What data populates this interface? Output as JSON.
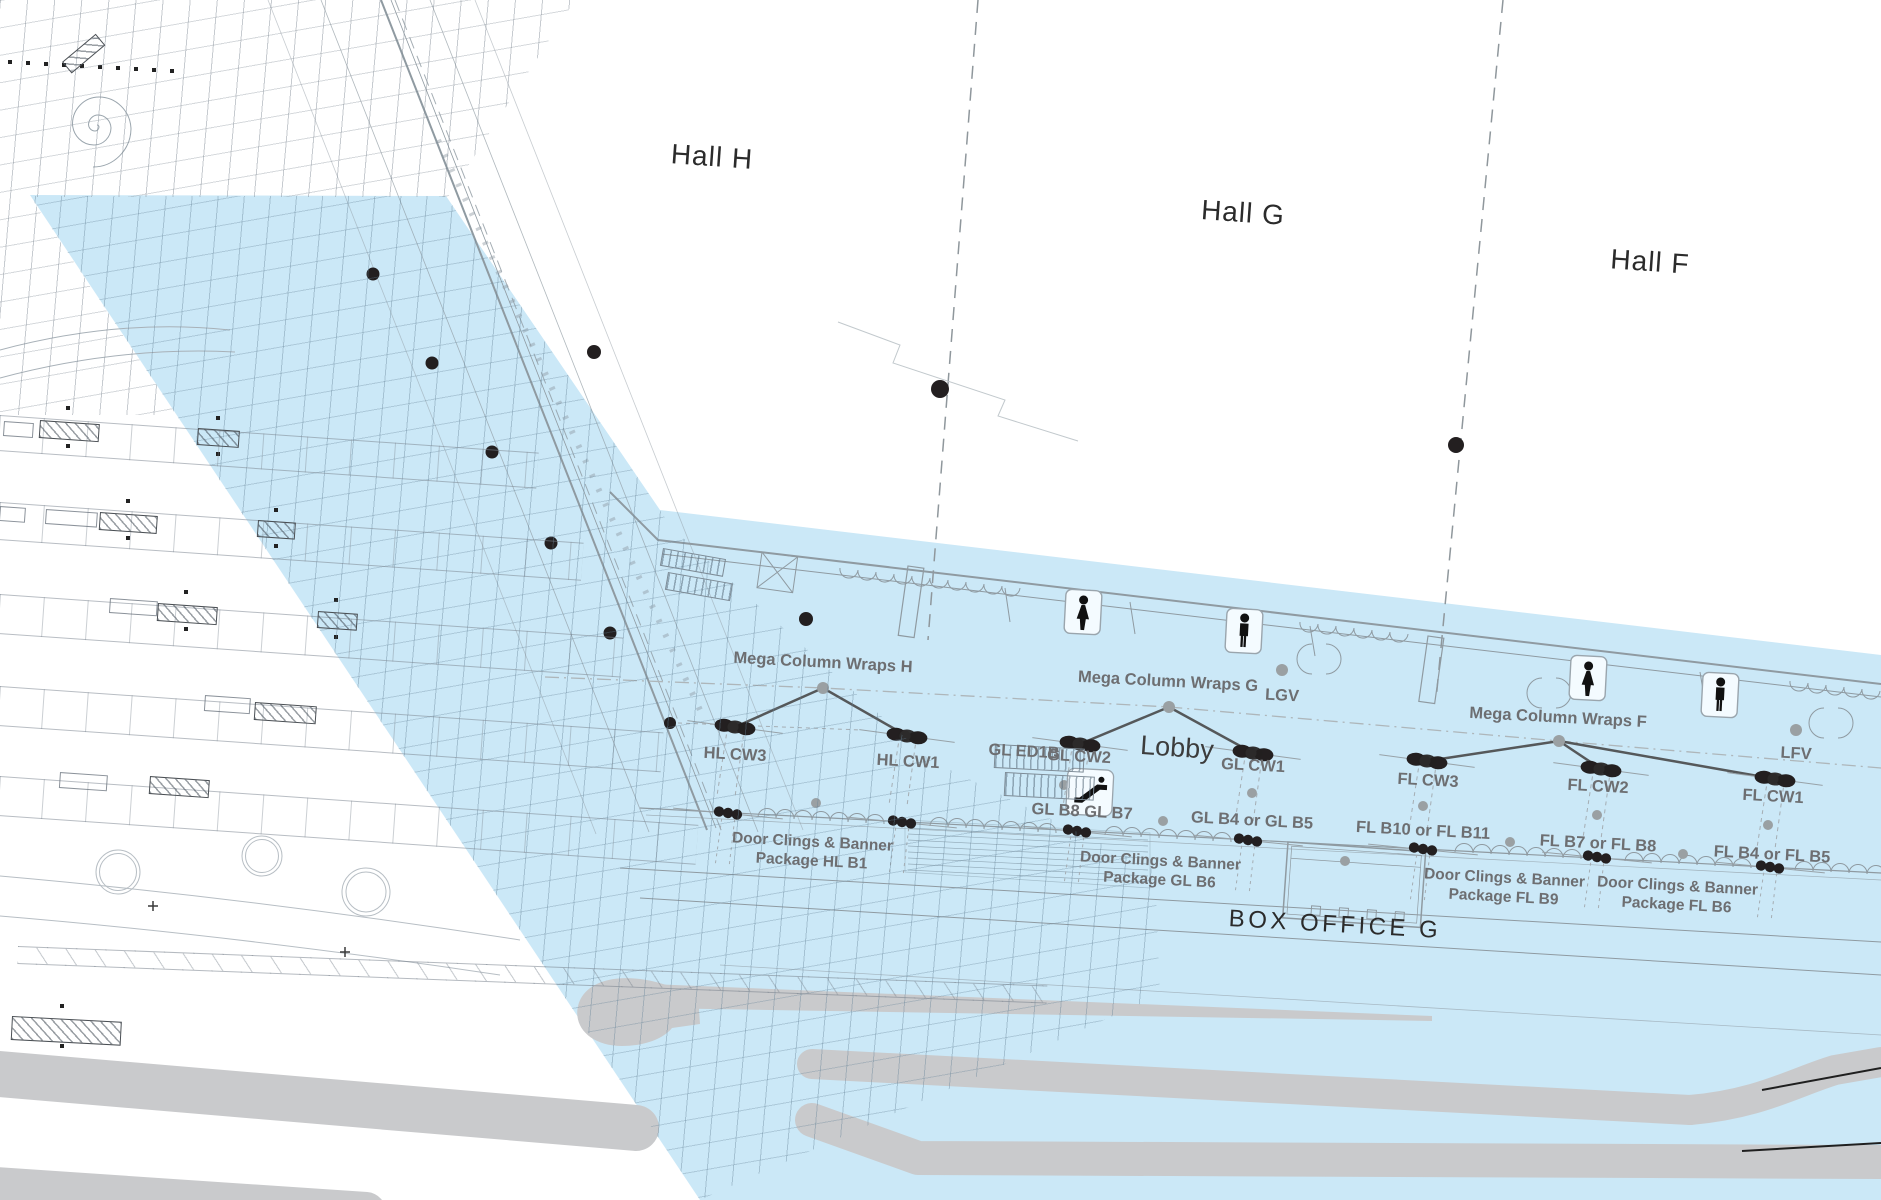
{
  "theme": {
    "highlight": "#cbe8f7",
    "road": "#c9cacc",
    "ink": "#231f20",
    "label_gray": "#6d6e71",
    "line_light": "#b7bec4",
    "line_mid": "#8f9aa1",
    "steel": "#8fa6b4",
    "gray_dot": "#9aa0a3"
  },
  "halls": [
    {
      "id": "H",
      "label": "Hall H"
    },
    {
      "id": "G",
      "label": "Hall G"
    },
    {
      "id": "F",
      "label": "Hall F"
    }
  ],
  "areas": {
    "lobby": "Lobby",
    "box_office": "BOX OFFICE G"
  },
  "signage": {
    "mega_column_wraps": [
      {
        "hall": "H",
        "label": "Mega Column Wraps H"
      },
      {
        "hall": "G",
        "label": "Mega Column Wraps G"
      },
      {
        "hall": "F",
        "label": "Mega Column Wraps F"
      }
    ],
    "video_walls": [
      {
        "id": "LGV",
        "label": "LGV"
      },
      {
        "id": "LFV",
        "label": "LFV"
      }
    ],
    "column_wraps": [
      {
        "id": "HL-CW3",
        "label": "HL CW3"
      },
      {
        "id": "HL-CW1",
        "label": "HL CW1"
      },
      {
        "id": "GL-ED1B",
        "label": "GL ED1B"
      },
      {
        "id": "GL-CW2",
        "label": "GL CW2"
      },
      {
        "id": "GL-CW1",
        "label": "GL CW1"
      },
      {
        "id": "FL-CW3",
        "label": "FL CW3"
      },
      {
        "id": "FL-CW2",
        "label": "FL CW2"
      },
      {
        "id": "FL-CW1",
        "label": "FL CW1"
      }
    ],
    "banner_spots": [
      {
        "id": "GL-B8-B7",
        "label": "GL B8 GL B7"
      },
      {
        "id": "GL-B4-B5",
        "label": "GL B4 or GL B5"
      },
      {
        "id": "FL-B10-B11",
        "label": "FL B10 or FL B11"
      },
      {
        "id": "FL-B7-B8",
        "label": "FL B7 or FL B8"
      },
      {
        "id": "FL-B4-B5",
        "label": "FL B4 or FL B5"
      }
    ],
    "door_packages": [
      {
        "line1": "Door Clings & Banner",
        "line2": "Package HL B1"
      },
      {
        "line1": "Door Clings & Banner",
        "line2": "Package GL B6"
      },
      {
        "line1": "Door Clings & Banner",
        "line2": "Package FL B9"
      },
      {
        "line1": "Door Clings & Banner",
        "line2": "Package FL B6"
      }
    ]
  },
  "icons": [
    "restroom-women-icon",
    "restroom-men-icon",
    "escalator-icon",
    "stairs-icon"
  ]
}
